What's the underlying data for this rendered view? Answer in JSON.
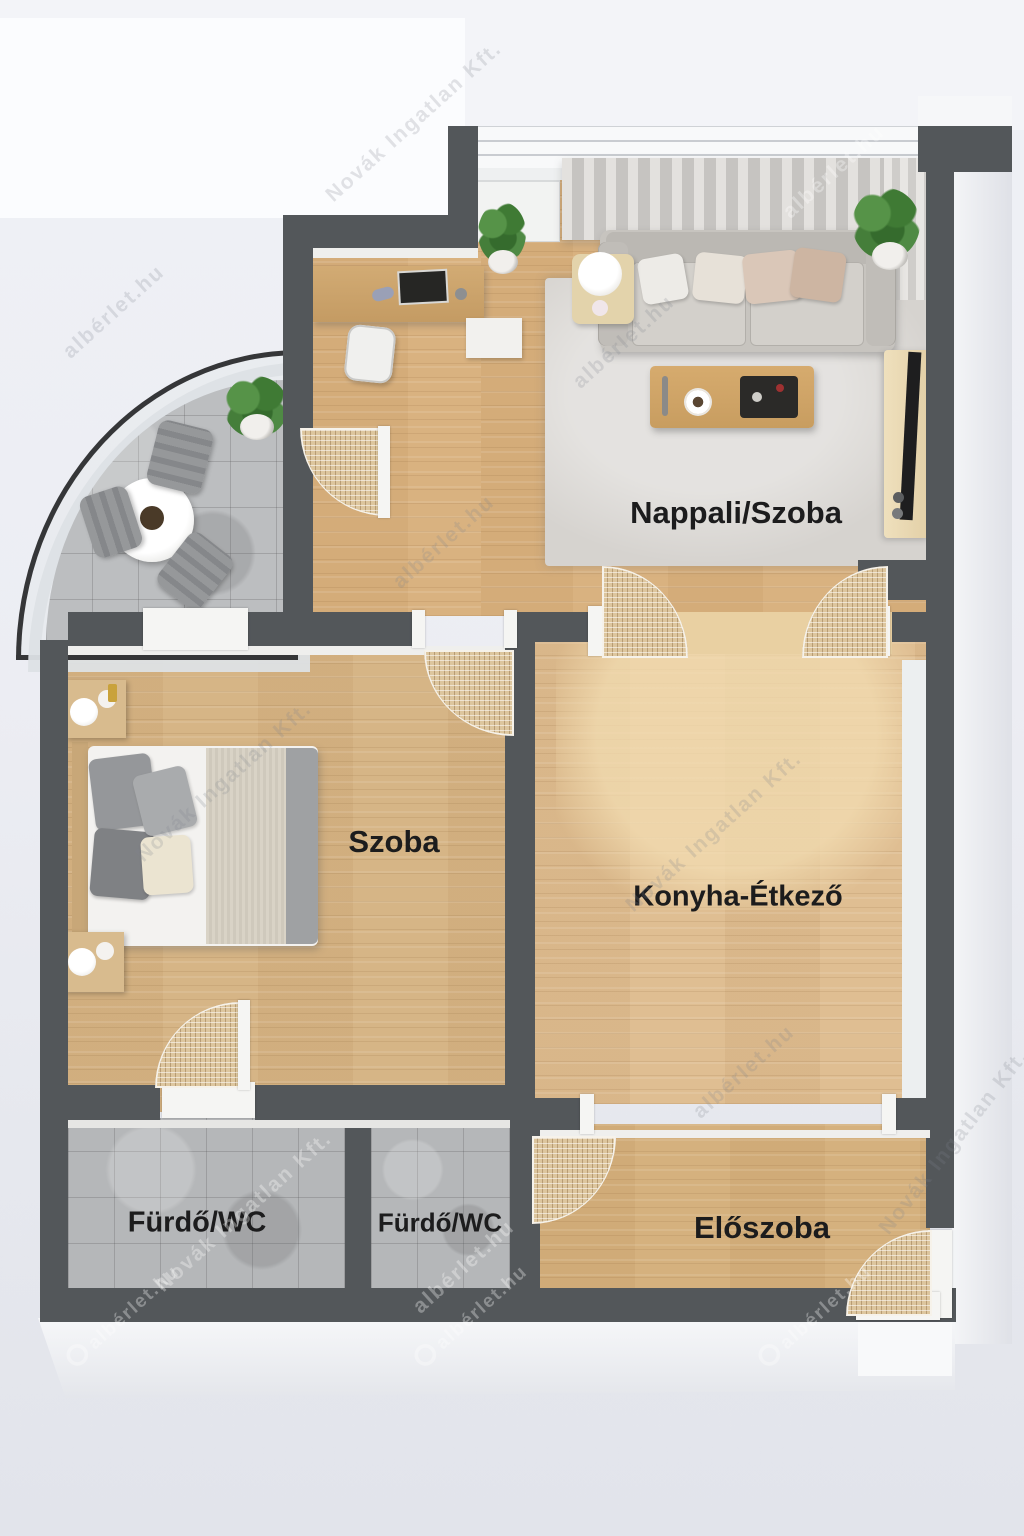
{
  "meta": {
    "kind": "3d-floor-plan-render",
    "language": "hu"
  },
  "rooms": {
    "living": {
      "label": "Nappali/Szoba"
    },
    "bedroom": {
      "label": "Szoba"
    },
    "kitchen": {
      "label": "Konyha-Étkező"
    },
    "bath1": {
      "label": "Fürdő/WC"
    },
    "bath2": {
      "label": "Fürdő/WC"
    },
    "hall": {
      "label": "Előszoba"
    }
  },
  "watermark": {
    "site": "albérlet.hu",
    "agency": "Novák Ingatlan Kft."
  },
  "colors": {
    "wall": "#53575a",
    "wood": "#d8b586",
    "wood_light": "#e9d0a2",
    "tile": "#b5b7b9",
    "rattan": "#ddc69e",
    "label_text": "#1c1c1d"
  }
}
